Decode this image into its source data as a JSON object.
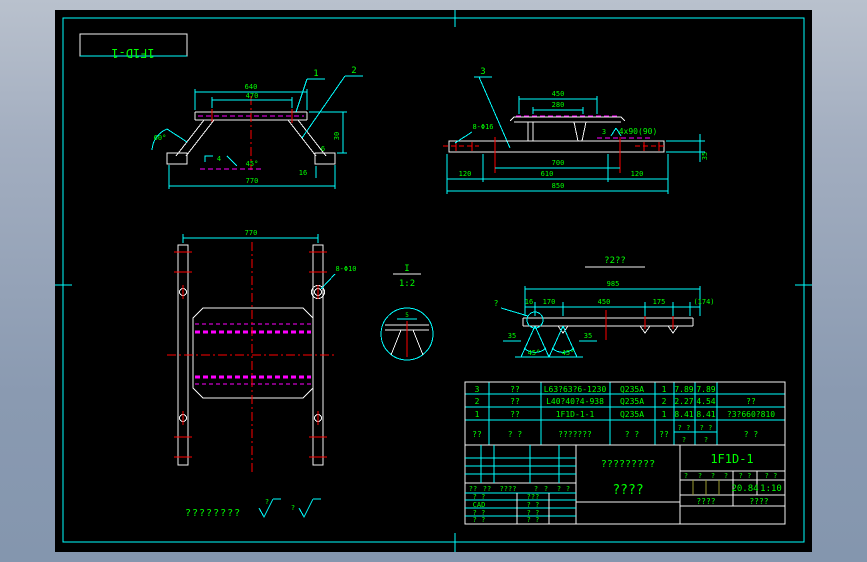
{
  "colors": {
    "background": "#000000",
    "frame": "#00ffff",
    "geometry": "#f2f2f2",
    "dimension_text": "#00ff00",
    "weld_line": "#ff00ff",
    "centerline": "#ff0000",
    "window_top": "#b9c1cd",
    "window_bottom": "#8496ae"
  },
  "stamp": {
    "number": "1F1D-1"
  },
  "views": {
    "bracket": {
      "balloon_1": "1",
      "balloon_2": "2",
      "dim_top": "640",
      "dim_inner": "470",
      "dim_bottom": "770",
      "dim_angle": "60°",
      "dim_height": "30",
      "dim_side": "6",
      "dim_foot": "16",
      "weld_size": "4",
      "weld_angle": "45°"
    },
    "assembly": {
      "balloon_3": "3",
      "dim_top": "450",
      "dim_inner": "280",
      "dim_span": "700",
      "dim_left": "120",
      "dim_mid": "610",
      "dim_right": "120",
      "dim_total": "850",
      "dim_thickness": "35",
      "hole_note": "8-Φ16",
      "weld_flag": "3",
      "weld_note": "4x90(90)"
    },
    "plan": {
      "dim_width": "770",
      "hole_note": "8-Φ10"
    },
    "detail": {
      "label": "I",
      "scale": "1:2",
      "dim": "5"
    },
    "development": {
      "title": "?2??",
      "detail_ref": "?",
      "dim_total": "985",
      "seg_1": "16",
      "seg_2": "170",
      "seg_3": "450",
      "seg_4": "175",
      "seg_5": "(174)",
      "side_left": "35",
      "side_right": "35",
      "angle_left": "45°",
      "angle_right": "45°"
    }
  },
  "parts_table": {
    "header": {
      "seq": "??",
      "code": "? ?",
      "name": "???????",
      "material": "? ?",
      "qty": "??",
      "unit_top": "? ?",
      "unit_sub": "?",
      "total_top": "? ?",
      "total_sub": "?",
      "remark": "? ?"
    },
    "rows": [
      {
        "seq": "3",
        "code": "??",
        "name": "L63?63?6-1230",
        "material": "Q235A",
        "qty": "1",
        "unit": "7.89",
        "total": "7.89",
        "remark": ""
      },
      {
        "seq": "2",
        "code": "??",
        "name": "L40?40?4-938",
        "material": "Q235A",
        "qty": "2",
        "unit": "2.27",
        "total": "4.54",
        "remark": "??"
      },
      {
        "seq": "1",
        "code": "??",
        "name": "1F1D-1-1",
        "material": "Q235A",
        "qty": "1",
        "unit": "8.41",
        "total": "8.41",
        "remark": "?3?660?810"
      }
    ]
  },
  "title_block": {
    "rev_header": {
      "c1": "??",
      "c2": "??",
      "c3": "????",
      "c4": "?",
      "c5": "?",
      "c6": "?",
      "c7": "?"
    },
    "rows": [
      {
        "left": "? ?",
        "mid": "???"
      },
      {
        "left": "CAD",
        "mid": "? ?"
      },
      {
        "left": "? ?",
        "mid": "? ?"
      },
      {
        "left": "? ?",
        "mid": "? ?"
      }
    ],
    "name_line1": "?????????",
    "name_line2": "????",
    "drawing_number": "1F1D-1",
    "mark_1": "?",
    "mark_2": "?",
    "mark_3": "?",
    "mark_4": "?",
    "weight_label": "? ?",
    "scale_label": "? ?",
    "weight_value": "20.84",
    "scale_value": "1:10",
    "sheet_left": "????",
    "sheet_right": "????"
  },
  "notes": {
    "remark": "????????",
    "rough_1": "?",
    "rough_2": "?"
  }
}
